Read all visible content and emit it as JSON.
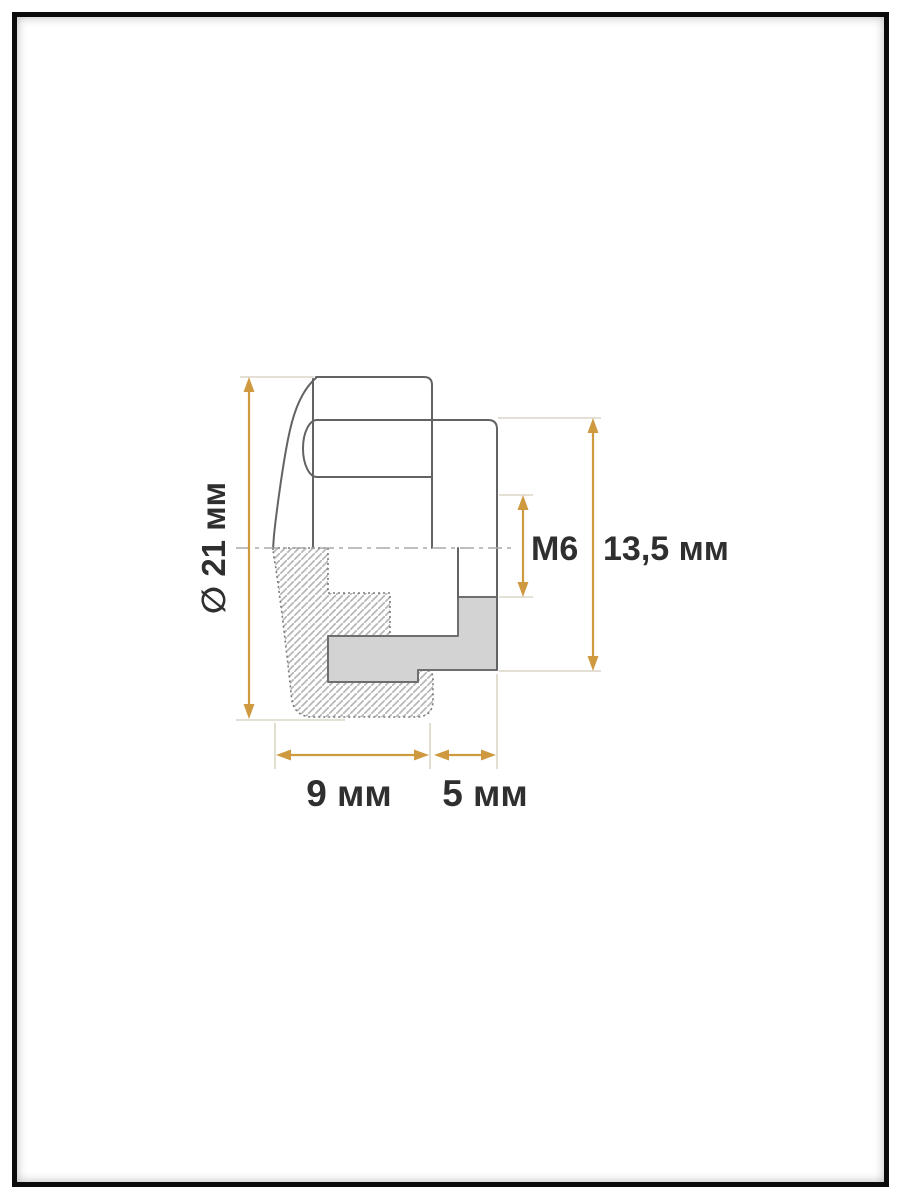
{
  "title": "Cap nut cross-section technical drawing",
  "labels": {
    "diameter": "∅ 21 мм",
    "thread": "M6",
    "insert_height": "13,5 мм",
    "body_width": "9 мм",
    "flange_width": "5 мм"
  },
  "colors": {
    "dimension_accent": "#cf9a3f",
    "outline": "#636363",
    "hatch_outline": "#7a7a7a",
    "extension_line": "#dcd5c7",
    "centerline": "#a8a8a8",
    "text": "#2f2f2f",
    "section_fill": "#d3d3d3",
    "section_border": "#6e6e6e",
    "hatch_line": "#b8b8b8",
    "frame": "#0b0b0b",
    "canvas": "#ffffff"
  }
}
